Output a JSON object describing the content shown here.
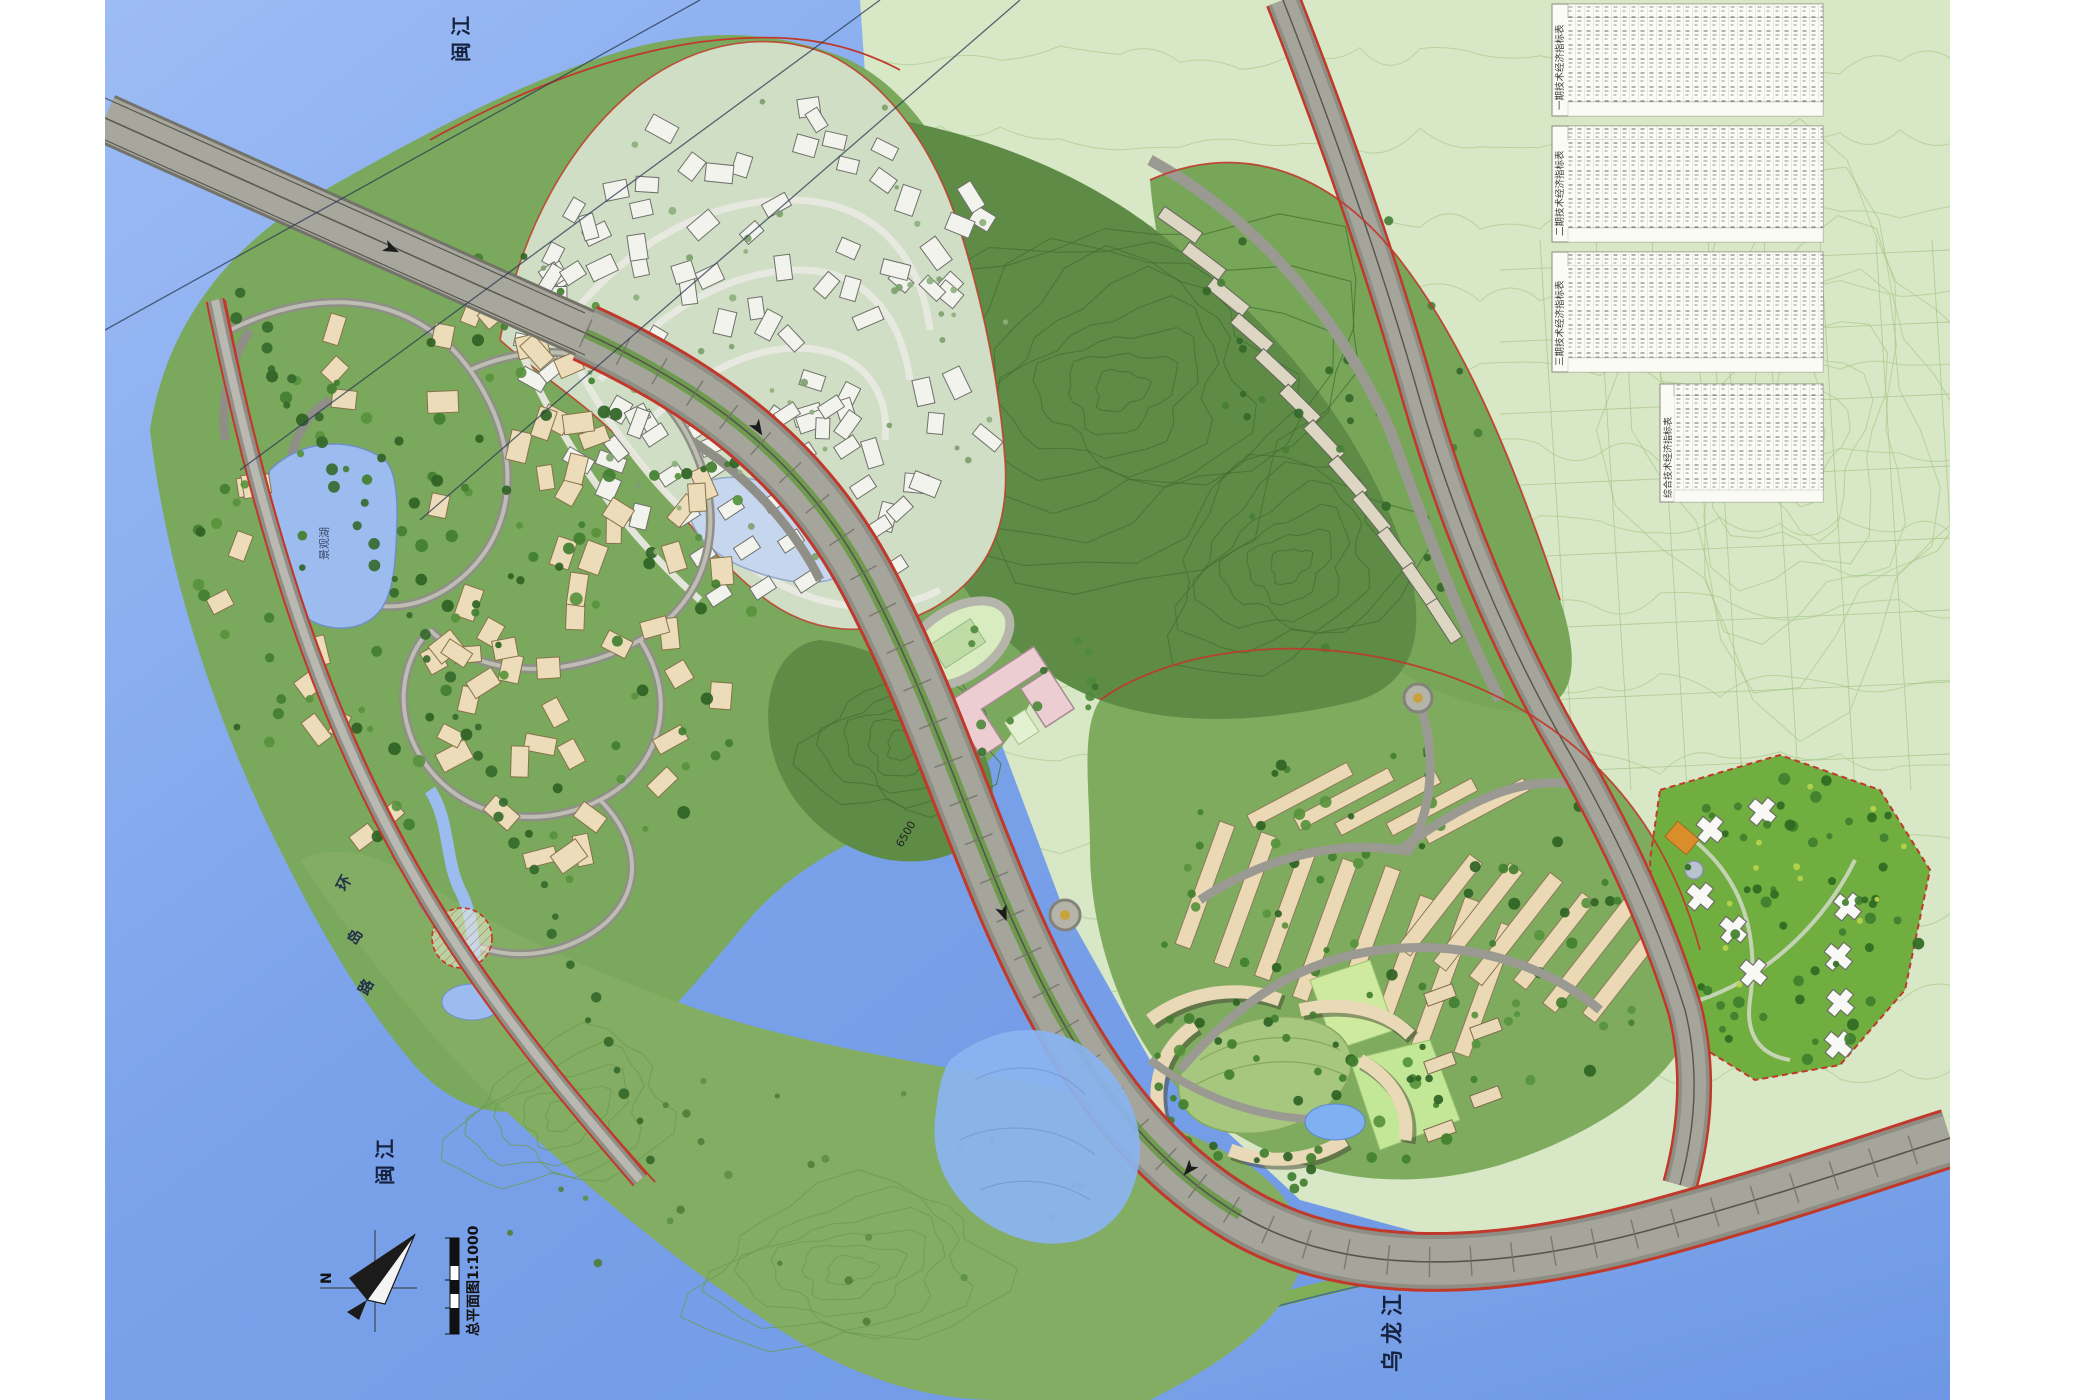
{
  "map": {
    "type": "residential-master-plan",
    "labels": {
      "river_top": "闽江",
      "river_bottom_left": "闽江",
      "river_bottom_right": "乌龙江",
      "coast_road_chars": [
        "环",
        "岛",
        "路"
      ],
      "lake_label": "景观湖",
      "scale_caption": "总平面图1:1000",
      "north_indicator": "N",
      "road_dimension": "6500"
    },
    "tables": {
      "items": [
        {
          "title": "一期技术经济指标表"
        },
        {
          "title": "二期技术经济指标表"
        },
        {
          "title": "三期技术经济指标表"
        },
        {
          "title": "综合技术经济指标表"
        }
      ]
    },
    "colors": {
      "water": "#7aa2ea",
      "water_light": "#a7c2f5",
      "plain_green": "#d8e7c5",
      "island_green": "#7aa85c",
      "forest_green": "#5e8c46",
      "villa_pale": "#cfdec4",
      "house_beige": "#ecdcba",
      "house_white": "#f3f3ee",
      "school_pink": "#eccdd2",
      "road_gray": "#a5a59b",
      "boundary_red": "#c0392b",
      "median_green": "#6f9b4f"
    }
  }
}
